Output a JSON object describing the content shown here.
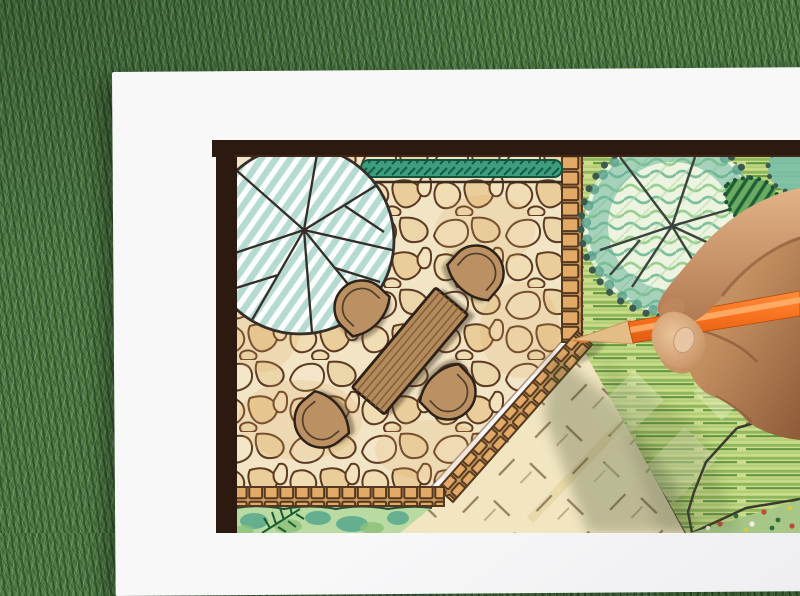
{
  "scene": {
    "type": "photograph",
    "description": "Hand holding an orange colored pencil while drawing a landscape architecture garden plan on a white sheet of paper lying on green grass. The plan shows a flagstone patio with a wooden dining table and four chairs, two round shade-tree symbols, a hedge strip, brick edging, colored-pencil lawn, a dashed groundcover area and planting beds.",
    "objects": [
      "grass-background",
      "paper-sheet",
      "plan-frame",
      "flagstone-patio",
      "shade-tree-top-left",
      "shade-tree-top-right",
      "hedge-strip",
      "hatched-shrub",
      "garden-table",
      "patio-chairs",
      "brick-edging",
      "lawn-area",
      "groundcover-dashed-area",
      "planting-bed-bottom",
      "planting-bed-corner",
      "hand",
      "orange-pencil"
    ]
  },
  "colors": {
    "grass": "#4e7a43",
    "paper": "#f8f8f9",
    "frame": "#2c1a10",
    "stone-bg": "#f1e5c6",
    "stone-line": "#5d3a22",
    "brick": "#e2a967",
    "brick-joint": "#54381f",
    "hedge": "#3f9d7f",
    "hedge-dark": "#17654b",
    "tree-hatch": "#b4dad2",
    "tree-line": "#352e28",
    "scallop-line": "#3c5a50",
    "lawn-base": "#cbdd8d",
    "lawn-stroke": "#649543",
    "dash-bg": "#f2e6c2",
    "dash-mark": "#97805f",
    "wood": "#b58a5b",
    "chair": "#bb9164",
    "outline-dark": "#2e2217",
    "bed-green": "#b9dba2",
    "bed-teal": "#57a88e",
    "fern": "#1d5c33",
    "skin": "#c28e60",
    "skin-light": "#e2b286",
    "skin-dark": "#8d5a38",
    "pencil": "#f97420",
    "pencil-light": "#ffb26e",
    "pencil-wood": "#e3bc86"
  }
}
